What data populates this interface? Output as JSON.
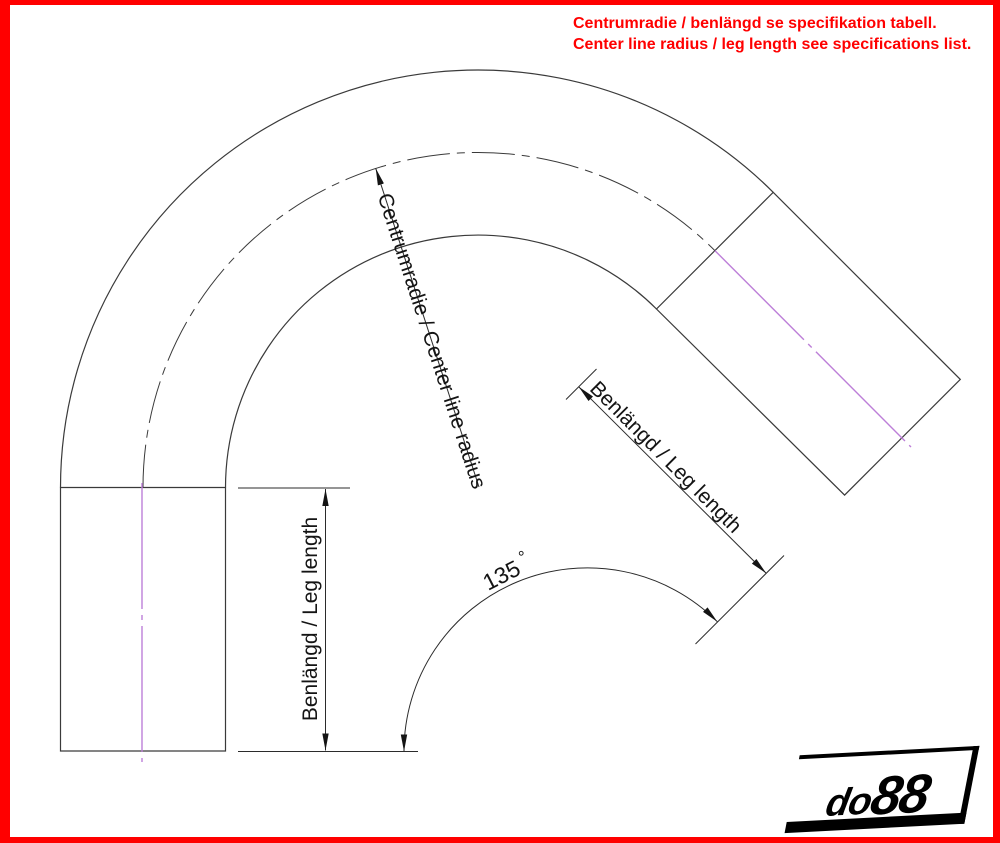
{
  "note": {
    "line1": "Centrumradie / benlängd se specifikation tabell.",
    "line2": "Center line radius / leg length see specifications list."
  },
  "dims": {
    "radius_label": "Centrumradie / Center line radius",
    "left_leg_label": "Benlängd / Leg length",
    "right_leg_label": "Benlängd / Leg length",
    "angle_value": "135",
    "degree_symbol": "°"
  },
  "drawing": {
    "type": "technical-drawing",
    "subject": "135-degree silicone hose bend, side view",
    "bend_angle_deg": 135,
    "elements": [
      "outer-contour",
      "inner-contour",
      "center-line-arc",
      "leg-center-lines",
      "radius-dimension",
      "left-leg-length-dimension",
      "right-leg-length-dimension",
      "angle-dimension"
    ]
  },
  "logo": {
    "prefix": "do",
    "suffix": "88"
  },
  "colors": {
    "frame_red": "#ff0000",
    "note_red": "#ff0000",
    "line_dark": "#3a3a3a",
    "centerline_pink": "#bd7fd8",
    "arrow_fill": "#141414"
  }
}
